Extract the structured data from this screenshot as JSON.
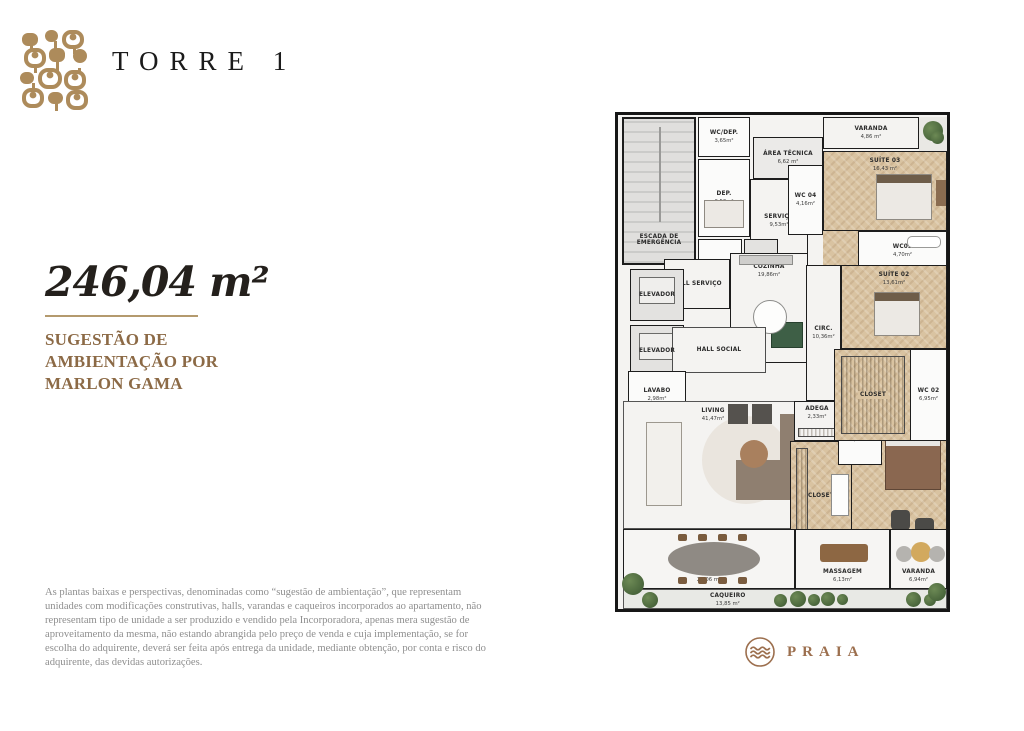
{
  "header": {
    "title": "TORRE 1",
    "logo_icon": "mosaic-tiles-icon"
  },
  "unit": {
    "area": "246,04 m²",
    "credit_lines": {
      "l1": "SUGESTÃO DE",
      "l2": "AMBIENTAÇÃO POR",
      "l3": "MARLON GAMA"
    }
  },
  "disclaimer": "As plantas baixas e perspectivas, denominadas como “sugestão de ambientação”, que representam unidades com modificações construtivas, halls, varandas e caqueiros incorporados ao apartamento, não representam tipo de unidade a ser produzido e vendido pela Incorporadora, apenas mera sugestão de aproveitamento da mesma, não estando abrangida pelo preço de venda e cuja implementação, se for escolha do adquirente, deverá ser feita após entrega da unidade, mediante obtenção, por conta e risco do adquirente, das devidas autorizações.",
  "brand": {
    "name": "PRAIA",
    "icon": "waves-icon"
  },
  "colors": {
    "gold": "#ad8b5b",
    "brown_text": "#8c6a46",
    "dark": "#1b1b1b",
    "gray_text": "#8e8e8e",
    "wood": "#d9c3a1",
    "wall": "#1d1d1d",
    "brand_brown": "#9c6f4e"
  },
  "plan": {
    "rooms": {
      "escada": {
        "name": "ESCADA DE EMERGÊNCIA",
        "area": ""
      },
      "wc_dep": {
        "name": "WC/DEP.",
        "area": "3,65m²"
      },
      "dep": {
        "name": "DEP.",
        "area": "6,53m²"
      },
      "dml": {
        "name": "DML",
        "area": ""
      },
      "elev_delivery": {
        "name": "ELEV. DELIVERY",
        "area": ""
      },
      "area_tecnica": {
        "name": "ÁREA TÉCNICA",
        "area": "6,62 m²"
      },
      "servico": {
        "name": "SERVIÇO",
        "area": "9,53m²"
      },
      "varanda_top": {
        "name": "VARANDA",
        "area": "4,86 m²"
      },
      "suite03": {
        "name": "SUÍTE 03",
        "area": "16,43 m²"
      },
      "wc04": {
        "name": "WC 04",
        "area": "4,16m²"
      },
      "wc03": {
        "name": "WC03",
        "area": "4,70m²"
      },
      "suite02": {
        "name": "SUÍTE 02",
        "area": "13,61m²"
      },
      "elevador1": {
        "name": "ELEVADOR",
        "area": ""
      },
      "elevador2": {
        "name": "ELEVADOR",
        "area": ""
      },
      "hall_servico": {
        "name": "HALL SERVIÇO",
        "area": ""
      },
      "hall_social": {
        "name": "HALL SOCIAL",
        "area": ""
      },
      "lavabo": {
        "name": "LAVABO",
        "area": "2,98m²"
      },
      "cozinha": {
        "name": "COZINHA",
        "area": "19,86m²"
      },
      "circ": {
        "name": "CIRC.",
        "area": "10,36m²"
      },
      "closet_sup": {
        "name": "CLOSET",
        "area": ""
      },
      "wc02": {
        "name": "WC 02",
        "area": "6,95m²"
      },
      "living": {
        "name": "LIVING",
        "area": "41,47m²"
      },
      "adega": {
        "name": "ADEGA",
        "area": "2,33m²"
      },
      "wc01": {
        "name": "WC 01",
        "area": "3,69m²"
      },
      "closet_master": {
        "name": "CLOSET",
        "area": ""
      },
      "suite_master": {
        "name": "SUÍTE MASTER",
        "area": "20,93m²"
      },
      "varanda_main": {
        "name": "VARANDA",
        "area": "24,06 m²"
      },
      "massagem": {
        "name": "MASSAGEM",
        "area": "6,13m²"
      },
      "varanda2": {
        "name": "VARANDA",
        "area": "6,94m²"
      },
      "caqueiro": {
        "name": "CAQUEIRO",
        "area": "13,85 m²"
      }
    }
  }
}
